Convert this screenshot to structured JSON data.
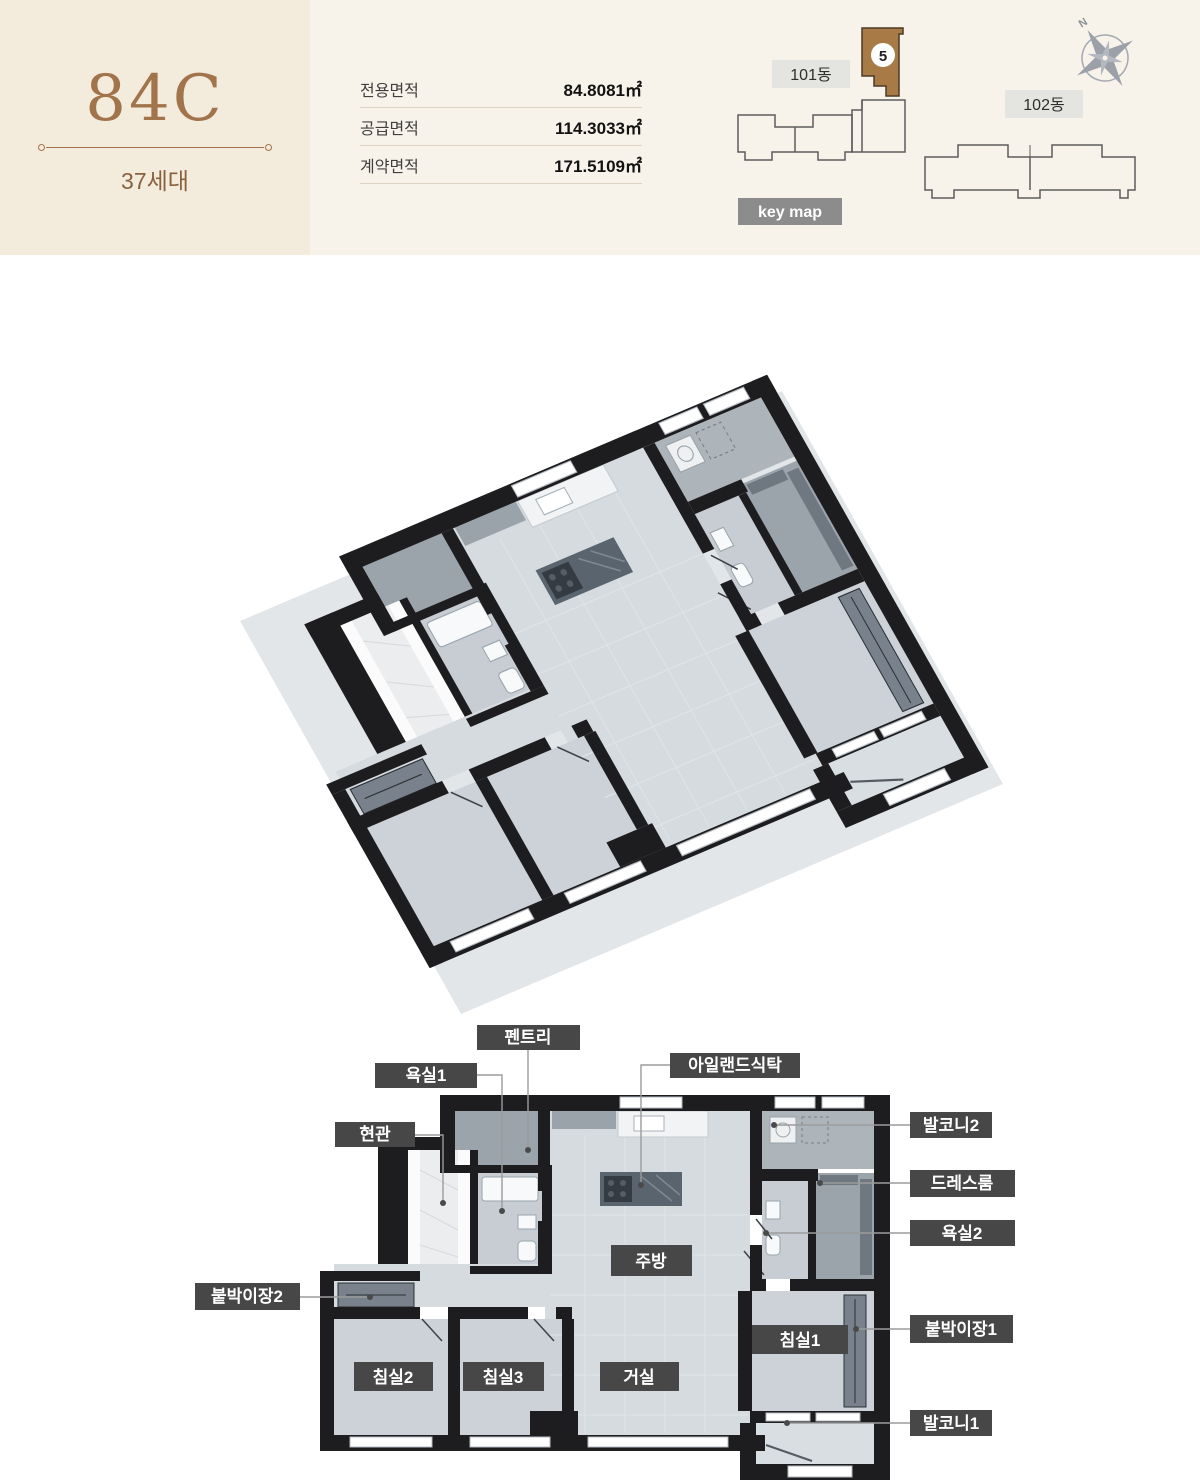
{
  "header": {
    "unit_code": "84C",
    "households": "37세대",
    "area_table": {
      "rows": [
        {
          "label": "전용면적",
          "value": "84.8081㎡"
        },
        {
          "label": "공급면적",
          "value": "114.3033㎡"
        },
        {
          "label": "계약면적",
          "value": "171.5109㎡"
        }
      ]
    },
    "keymap": {
      "building_101": "101동",
      "building_102": "102동",
      "unit_badge": "5",
      "keymap_label": "key map",
      "compass_north": "N"
    }
  },
  "plan": {
    "rooms": {
      "kitchen": "주방",
      "living": "거실",
      "bed1": "침실1",
      "bed2": "침실2",
      "bed3": "침실3"
    },
    "callouts": {
      "pantry": "펜트리",
      "bath1": "욕실1",
      "island": "아일랜드식탁",
      "entry": "현관",
      "closet2": "붙박이장2",
      "balcony2": "발코니2",
      "dress": "드레스룸",
      "bath2": "욕실2",
      "closet1": "붙박이장1",
      "balcony1": "발코니1"
    }
  },
  "colors": {
    "accent_brown": "#a2744c",
    "header_left_bg": "#f3ecdd",
    "header_right_bg": "#f8f3ea",
    "label_box": "#474747",
    "keymap_badge_bg": "#8c8c8c",
    "highlight_unit": "#a87a45",
    "wall": "#1d1d1f"
  }
}
